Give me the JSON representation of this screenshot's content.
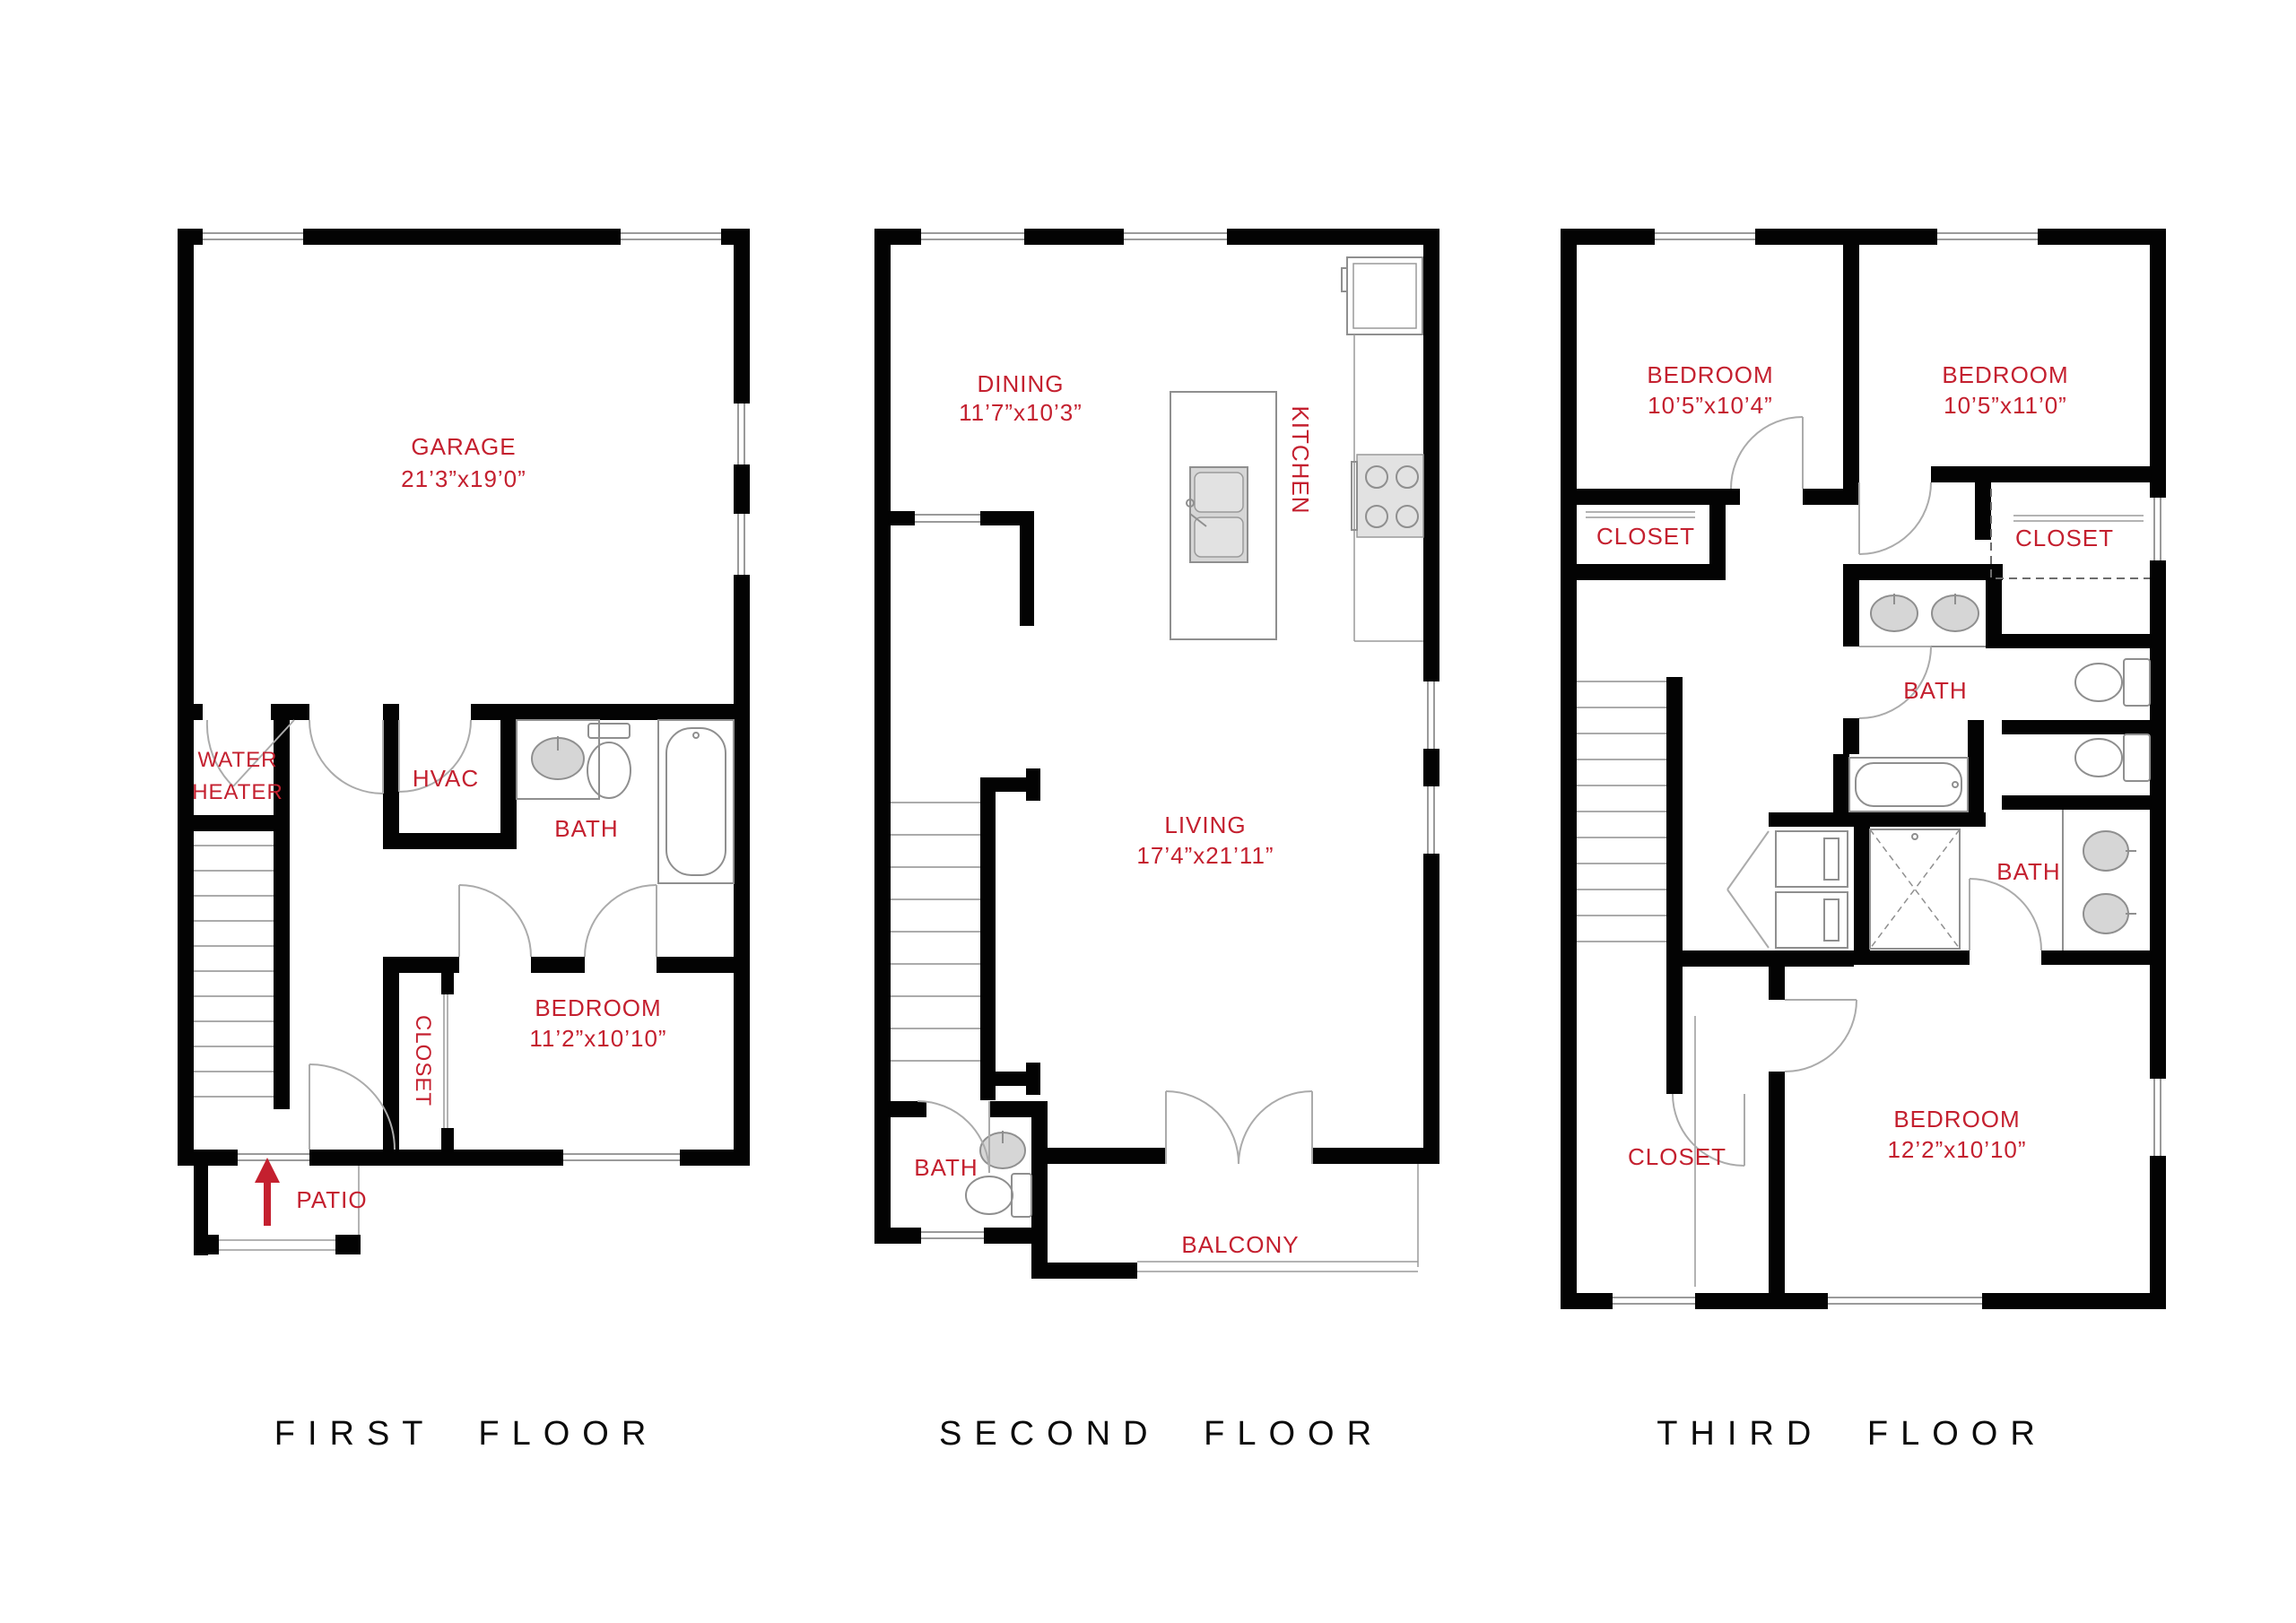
{
  "colors": {
    "label_red": "#c4202f",
    "wall_black": "#030303"
  },
  "floors": [
    {
      "title": "FIRST FLOOR",
      "rooms": {
        "garage": {
          "name": "GARAGE",
          "dims": "21’3”x19’0”"
        },
        "water_heater": {
          "line1": "WATER",
          "line2": "HEATER"
        },
        "hvac": "HVAC",
        "bath": "BATH",
        "closet": "CLOSET",
        "bedroom": {
          "name": "BEDROOM",
          "dims": "11’2”x10’10”"
        },
        "patio": "PATIO"
      }
    },
    {
      "title": "SECOND FLOOR",
      "rooms": {
        "dining": {
          "name": "DINING",
          "dims": "11’7”x10’3”"
        },
        "kitchen": "KITCHEN",
        "living": {
          "name": "LIVING",
          "dims": "17’4”x21’11”"
        },
        "bath": "BATH",
        "balcony": "BALCONY"
      }
    },
    {
      "title": "THIRD FLOOR",
      "rooms": {
        "bedroom_left": {
          "name": "BEDROOM",
          "dims": "10’5”x10’4”"
        },
        "bedroom_right": {
          "name": "BEDROOM",
          "dims": "10’5”x11’0”"
        },
        "closet_left": "CLOSET",
        "closet_walkin": "CLOSET",
        "bath_upper": "BATH",
        "bath_lower": "BATH",
        "closet_bottom": "CLOSET",
        "bedroom_bottom": {
          "name": "BEDROOM",
          "dims": "12’2”x10’10”"
        }
      }
    }
  ]
}
